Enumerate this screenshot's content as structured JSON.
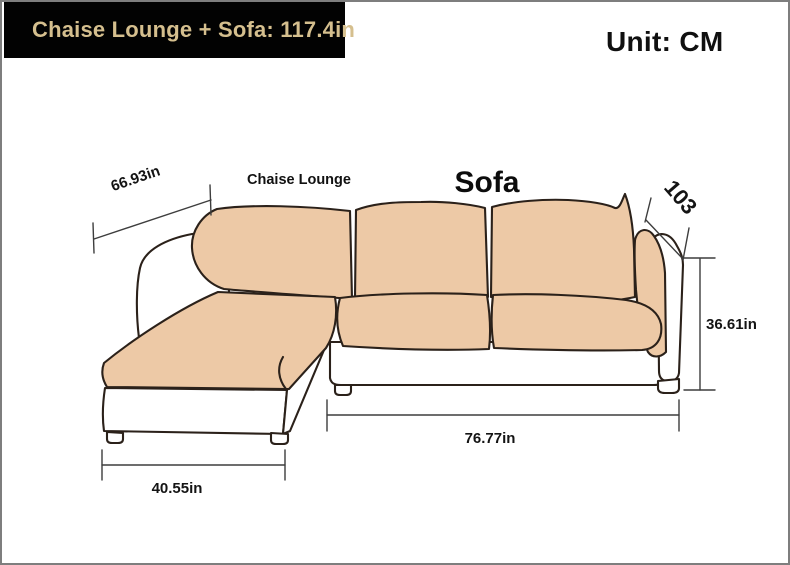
{
  "header": {
    "title": "Chaise Lounge + Sofa: 117.4in",
    "unit_label": "Unit: CM"
  },
  "diagram": {
    "chaise_label": "Chaise Lounge",
    "sofa_label": "Sofa",
    "dimensions": {
      "chaise_depth": "66.93in",
      "back_height_cm": "103",
      "right_height": "36.61in",
      "sofa_length": "76.77in",
      "chaise_width": "40.55in"
    },
    "colors": {
      "cushion_fill": "#edc9a6",
      "outline": "#2b211a",
      "title_bg": "#020202",
      "title_text": "#d5bf8e",
      "dimension_line": "#3d3d3d",
      "frame_border": "#7e7e7e"
    }
  }
}
